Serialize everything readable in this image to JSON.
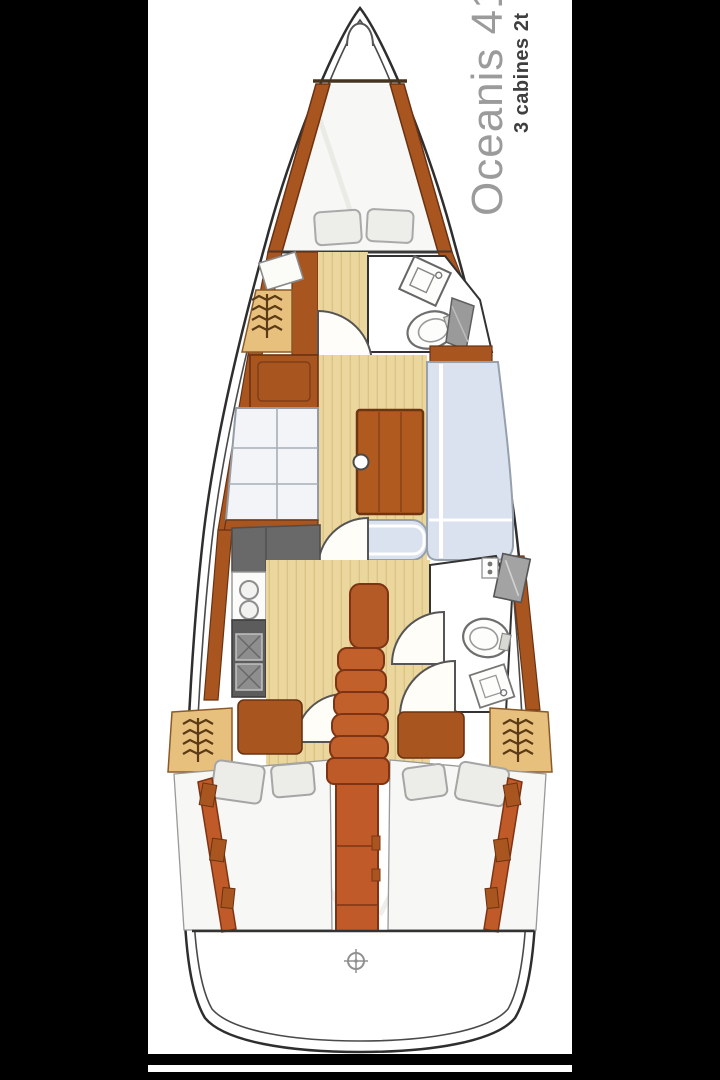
{
  "header": {
    "title": "Oceanis 41",
    "subtitle": "3 cabines 2t"
  },
  "colors": {
    "letterbox_black": "#000000",
    "paper_white": "#ffffff",
    "hull_line": "#2e2e2e",
    "wood_brown": "#a8551f",
    "wood_dark_edge": "#6b3312",
    "companionway_orange": "#c2602c",
    "floor_tan": "#ebd79e",
    "plank_line_tan": "#dbc384",
    "locker_tan": "#e8c07e",
    "sofa_blue": "#d9e2ee",
    "settee_pale": "#f2f4f7",
    "counter_gray": "#696969",
    "stove_gray": "#5c5c5c",
    "mattress_white": "#f7f7f5",
    "title_gray": "#9b9b9b",
    "subtitle_dark": "#3f3f3f"
  },
  "icons": {
    "hanger_icon": "stacked-zigzag-lines",
    "deck_fitting_icon": "crosshair-circle",
    "toilet_icon": "oval-bowl",
    "sink_icon": "basin-with-faucet",
    "stove_icon": "two-burner-hatched"
  }
}
